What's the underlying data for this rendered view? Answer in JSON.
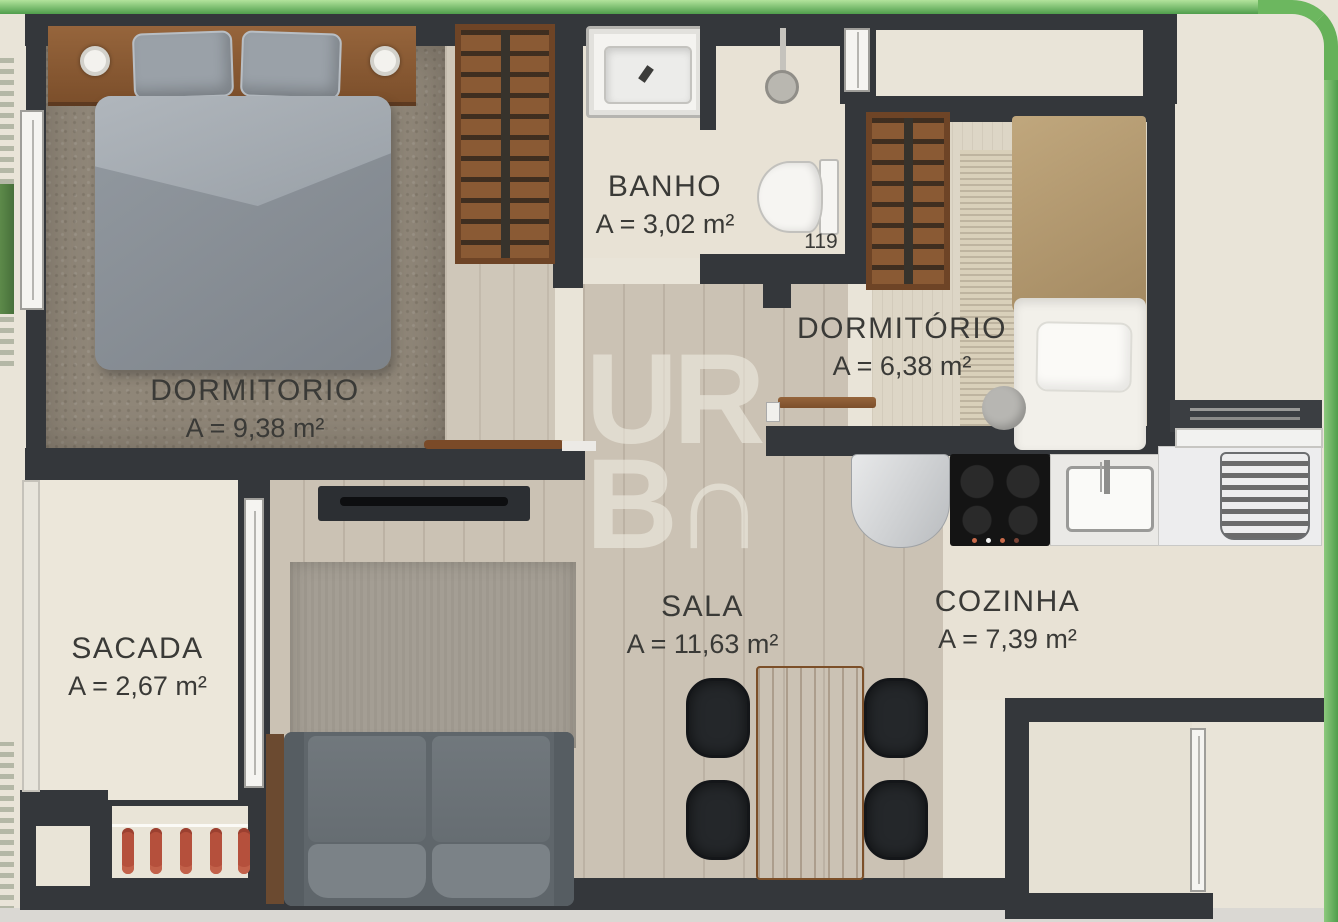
{
  "watermark": {
    "line1": "UR",
    "line2": "B∩"
  },
  "rooms": [
    {
      "id": "dormitorio-1",
      "name": "DORMITORIO",
      "area": "A = 9,38 m²"
    },
    {
      "id": "banho",
      "name": "BANHO",
      "area": "A = 3,02 m²",
      "note": "119"
    },
    {
      "id": "dormitorio-2",
      "name": "DORMITÓRIO",
      "area": "A = 6,38 m²"
    },
    {
      "id": "sala",
      "name": "SALA",
      "area": "A = 11,63 m²"
    },
    {
      "id": "cozinha",
      "name": "COZINHA",
      "area": "A = 7,39 m²"
    },
    {
      "id": "sacada",
      "name": "SACADA",
      "area": "A = 2,67 m²"
    }
  ],
  "palette": {
    "frame_green_light": "#b2e39c",
    "frame_green_dark": "#4f9e4c",
    "wall_charcoal": "#34373b",
    "floor_plank": "#cbc2b4",
    "floor_cream": "#e8e2d5",
    "carpet_taupe": "#8f8678",
    "wood_furniture": "#8a5a34",
    "bedding_gray": "#878d94",
    "bedding_tan": "#b3996f",
    "sofa_gray": "#6f767b",
    "chair_black": "#24272a",
    "flower_red": "#b5503c",
    "grass_green": "#6f9c5f",
    "label_text": "#3a3a37",
    "watermark_cream": "#f3f0e6"
  }
}
